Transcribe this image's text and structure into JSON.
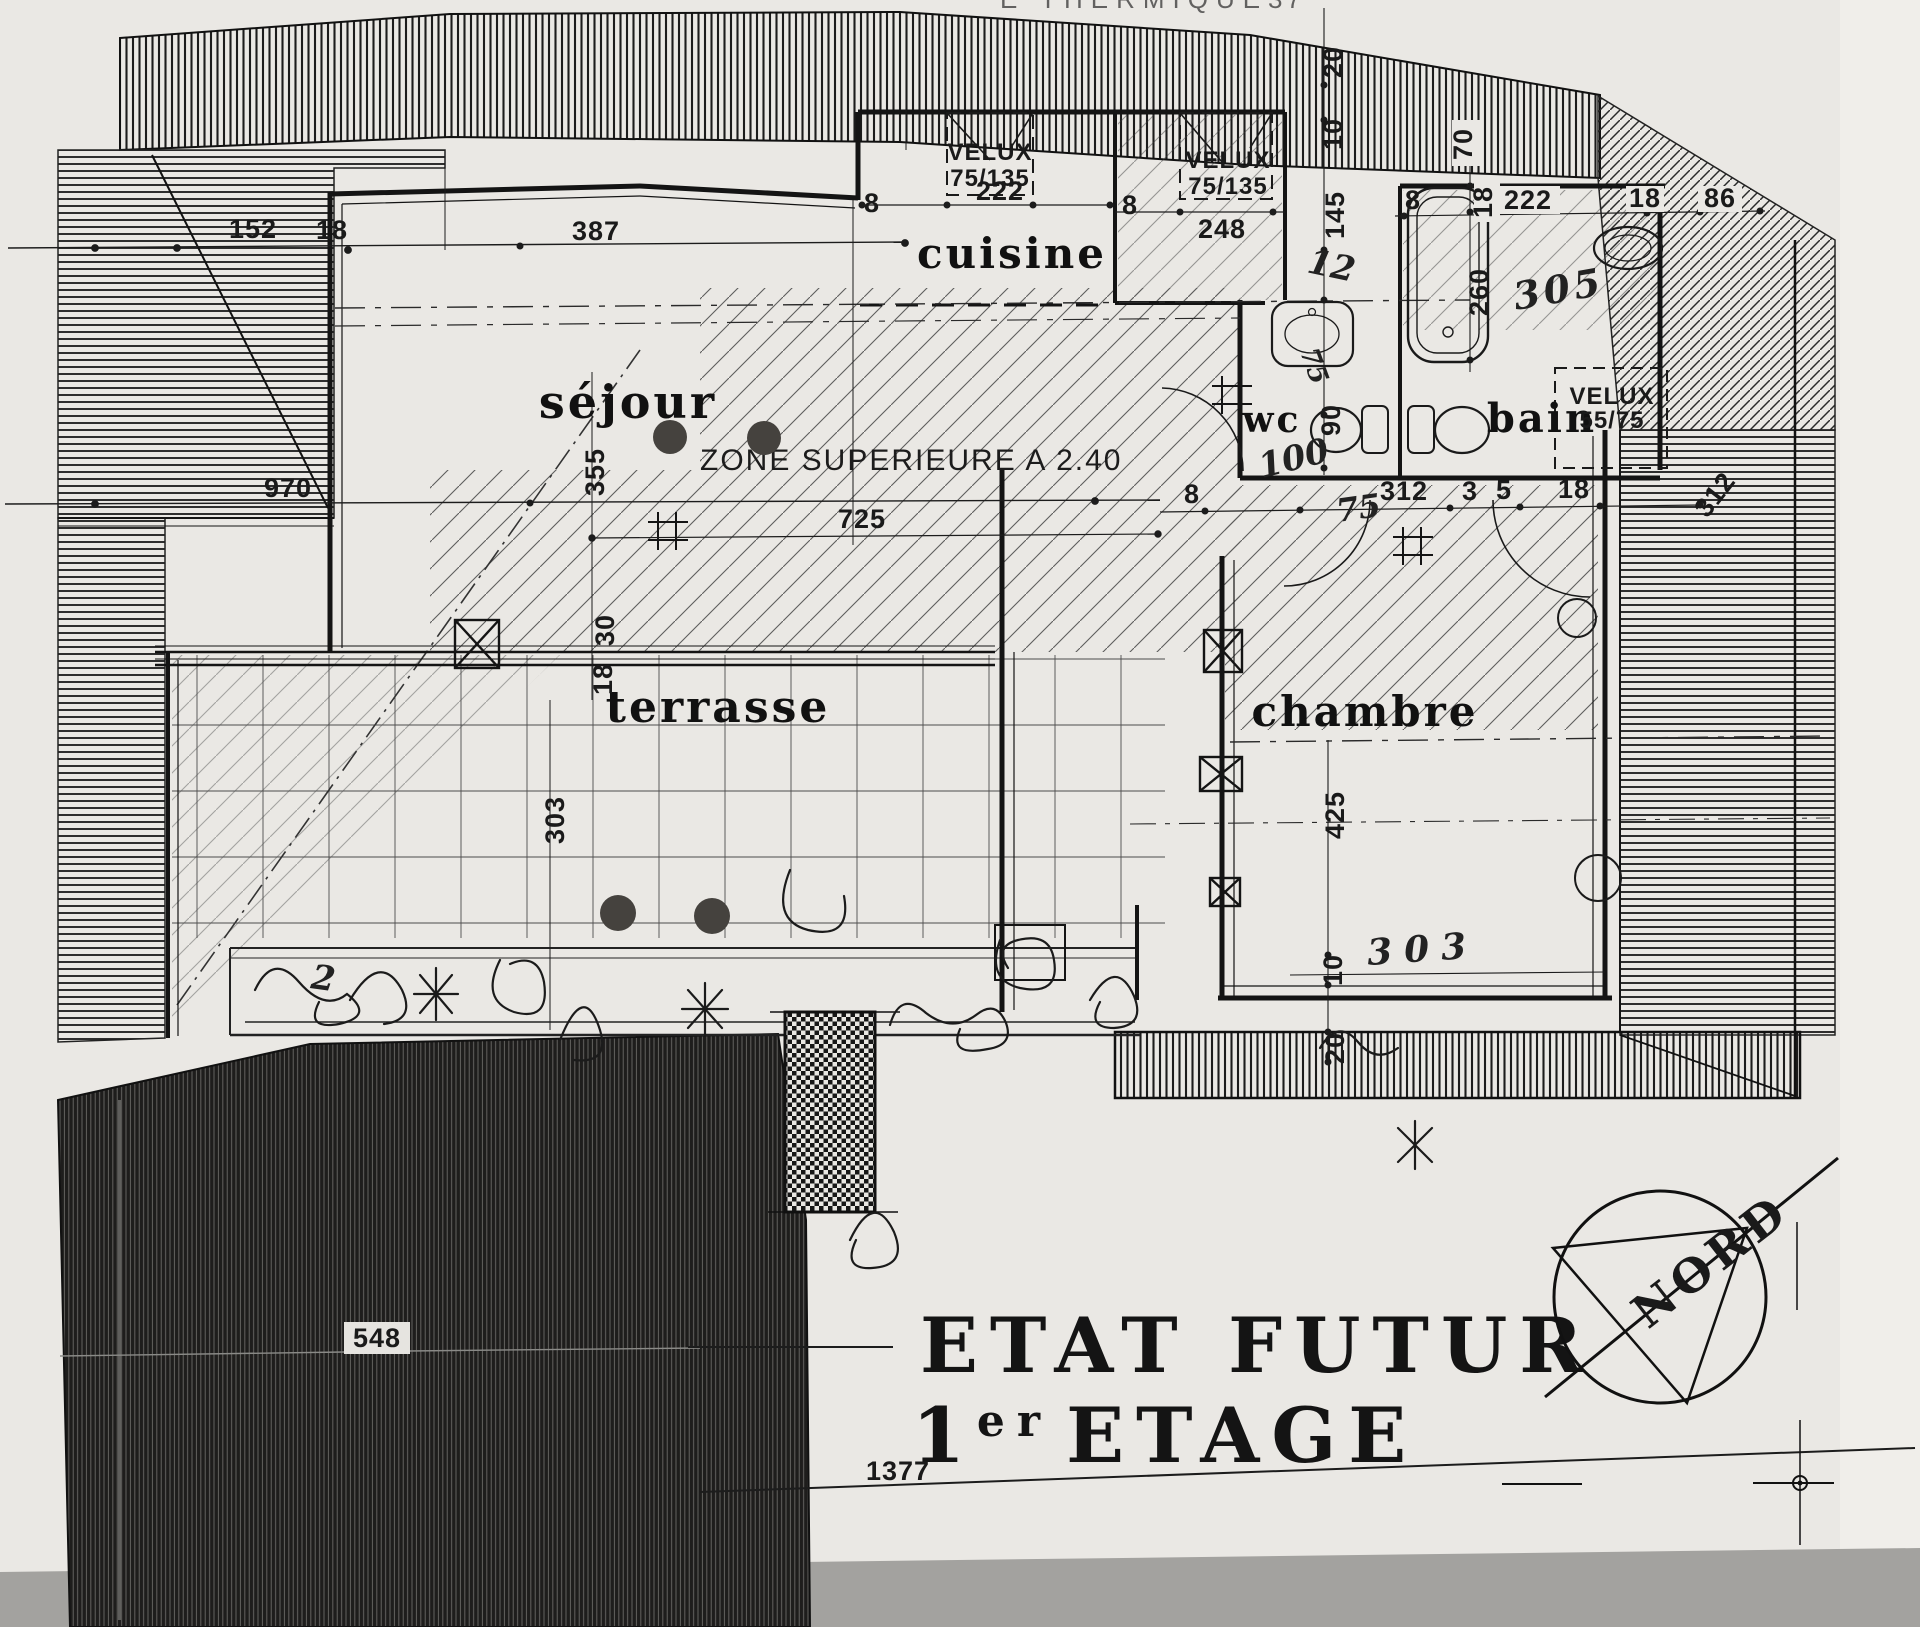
{
  "document": {
    "kind": "scanned architectural floor plan",
    "top_edge_text": "E THERMIQUE",
    "top_edge_number": "37",
    "title_line1": "ETAT FUTUR",
    "title_line2_num": "1",
    "title_line2_sup": "er",
    "title_line2_rest": "ETAGE",
    "bottom_overall_dim": "1377"
  },
  "rooms": {
    "sejour": "séjour",
    "cuisine": "cuisine",
    "terrasse": "terrasse",
    "chambre": "chambre",
    "bain": "bain",
    "wc": "wc"
  },
  "annotations": {
    "zone_note": "ZONE SUPERIEURE A 2.40",
    "velux1_name": "VELUX",
    "velux1_size": "75/135",
    "velux1_width": "222",
    "velux2_name": "VELUX",
    "velux2_size": "75/135",
    "velux2_width": "248",
    "velux3_name": "VELUX",
    "velux3_size": "55/75",
    "compass_label": "NORD"
  },
  "dimensions": {
    "left_roof_152": "152",
    "left_roof_18": "18",
    "sejour_top_387": "387",
    "left_970": "970",
    "sejour_width_725": "725",
    "sejour_height_355": "355",
    "wall_30": "30",
    "wall_18": "18",
    "terrace_height_303": "303",
    "cuisine_8_left": "8",
    "cuisine_8_right": "8",
    "top_20": "20",
    "top_10": "10",
    "top_145": "145",
    "hand_12": "12",
    "bain_8": "8",
    "bain_70": "70",
    "bain_18_vert": "18",
    "bain_260": "260",
    "bain_222": "222",
    "bain_18": "18",
    "bain_86": "86",
    "hand_305": "305",
    "wc_90": "90",
    "hand_100": "100",
    "chain_8": "8",
    "hand_75": "75",
    "chain_312": "312",
    "chain_3": "3",
    "chain_5": "5",
    "chain_18": "18",
    "right_312": "312",
    "chambre_425": "425",
    "chambre_10": "10",
    "chambre_20": "20",
    "hand_303": "303",
    "dark_548": "548",
    "hand_2": "2",
    "basin_75": "75"
  },
  "colors": {
    "paper": "#eae8e4",
    "ink": "#161616",
    "scan_band": "#a3a29f",
    "punch_hole": "#45423e"
  }
}
